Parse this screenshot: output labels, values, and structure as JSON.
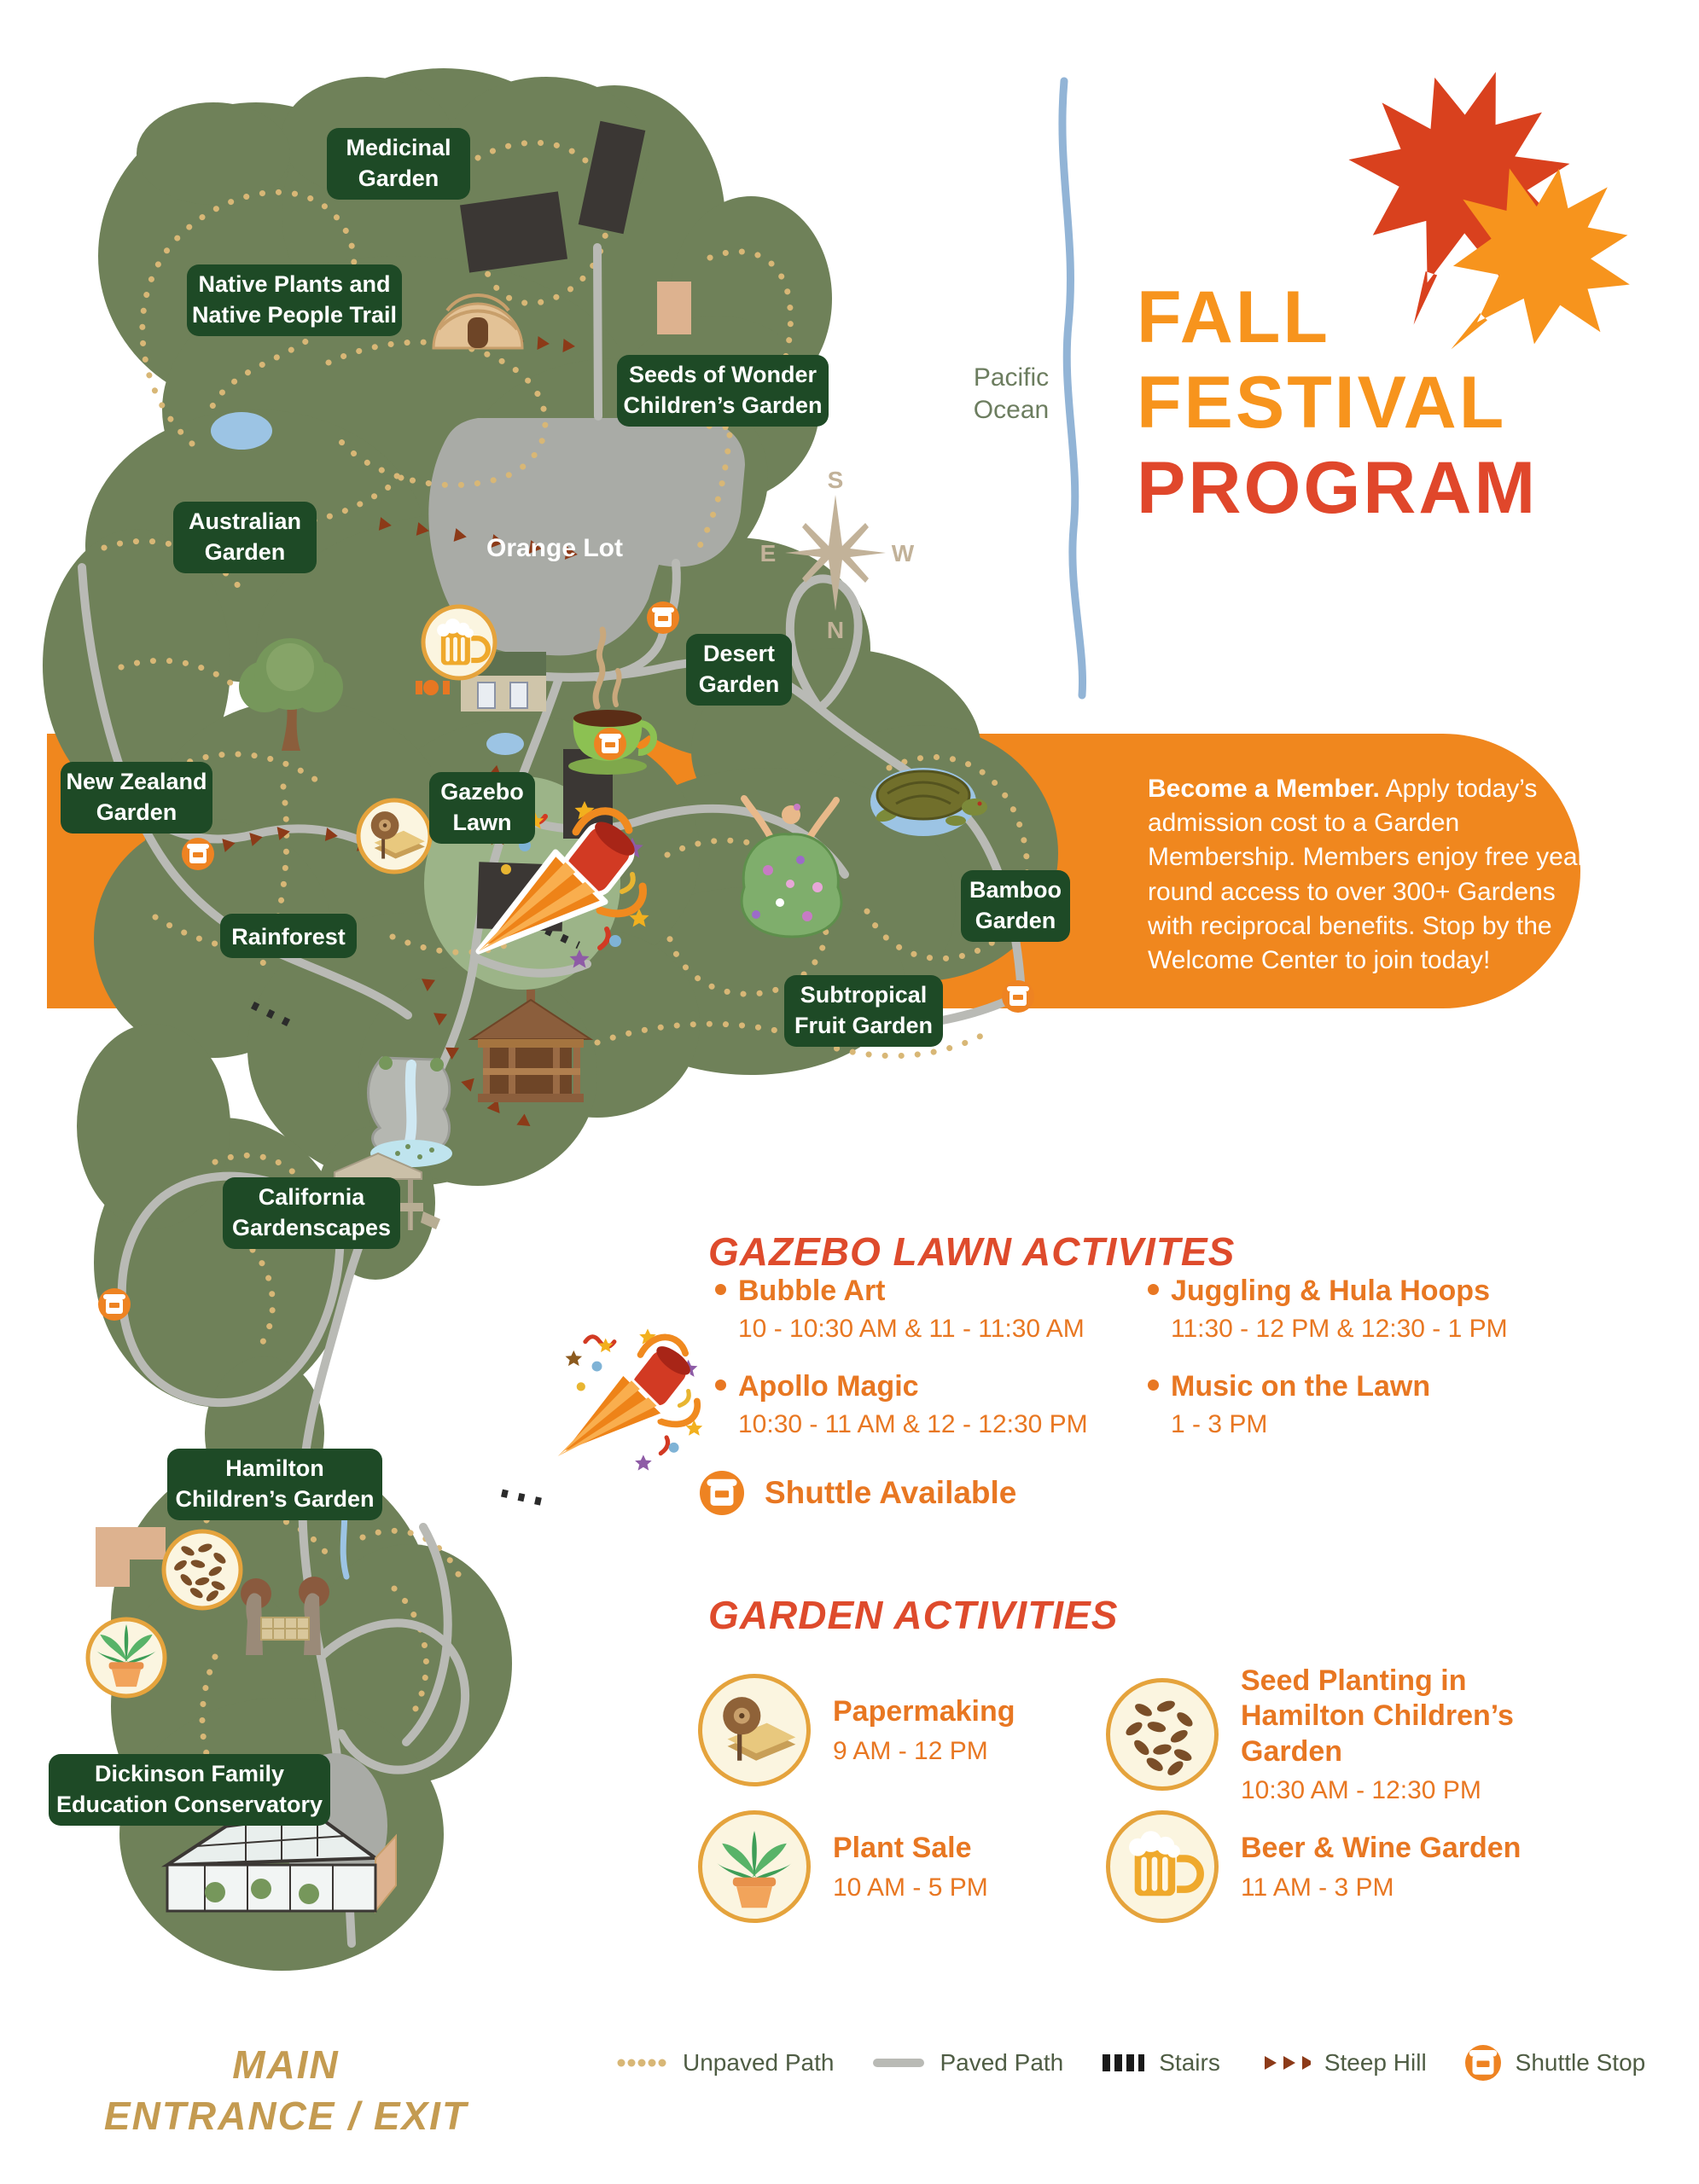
{
  "title": {
    "lines": [
      "FALL",
      "FESTIVAL",
      "PROGRAM"
    ]
  },
  "ocean": {
    "lines": [
      "Pacific",
      "Ocean"
    ]
  },
  "compass": {
    "top": "S",
    "left": "E",
    "right": "W",
    "bottom": "N"
  },
  "member_banner": {
    "lead": "Become a Member.",
    "body": " Apply today’s admission cost to a Garden Membership. Members enjoy free year round access to over 300+ Gardens with reciprocal benefits. Stop by the Welcome Center to join today!"
  },
  "map": {
    "orange_lot": "Orange Lot",
    "labels": [
      {
        "lines": [
          "Medicinal",
          "Garden"
        ]
      },
      {
        "lines": [
          "Native Plants and",
          "Native People Trail"
        ]
      },
      {
        "lines": [
          "Seeds of Wonder",
          "Children’s Garden"
        ]
      },
      {
        "lines": [
          "Australian",
          "Garden"
        ]
      },
      {
        "lines": [
          "Desert",
          "Garden"
        ]
      },
      {
        "lines": [
          "New Zealand",
          "Garden"
        ]
      },
      {
        "lines": [
          "Gazebo",
          "Lawn"
        ]
      },
      {
        "lines": [
          "Rainforest"
        ]
      },
      {
        "lines": [
          "Bamboo",
          "Garden"
        ]
      },
      {
        "lines": [
          "Subtropical",
          "Fruit Garden"
        ]
      },
      {
        "lines": [
          "California",
          "Gardenscapes"
        ]
      },
      {
        "lines": [
          "Hamilton",
          "Children’s Garden"
        ]
      },
      {
        "lines": [
          "Dickinson Family",
          "Education Conservatory"
        ]
      }
    ]
  },
  "gazebo_activities": {
    "heading": "GAZEBO LAWN ACTIVITES",
    "items": [
      {
        "name": "Bubble Art",
        "time": "10 - 10:30 AM & 11 - 11:30 AM"
      },
      {
        "name": "Apollo Magic",
        "time": "10:30 - 11 AM & 12 - 12:30 PM"
      },
      {
        "name": "Juggling & Hula Hoops",
        "time": "11:30 - 12 PM & 12:30 - 1 PM"
      },
      {
        "name": "Music on the Lawn",
        "time": "1 - 3 PM"
      }
    ],
    "shuttle_note": "Shuttle Available"
  },
  "garden_activities": {
    "heading": "GARDEN ACTIVITIES",
    "items": [
      {
        "name": "Papermaking",
        "time": "9 AM - 12 PM",
        "icon": "paper-roll-icon"
      },
      {
        "name": "Seed Planting in Hamilton Children’s Garden",
        "time": "10:30 AM - 12:30 PM",
        "icon": "seeds-icon"
      },
      {
        "name": "Plant Sale",
        "time": "10 AM - 5 PM",
        "icon": "potted-plant-icon"
      },
      {
        "name": "Beer & Wine Garden",
        "time": "11 AM - 3 PM",
        "icon": "beer-mug-icon"
      }
    ]
  },
  "entrance": {
    "lines": [
      "MAIN",
      "ENTRANCE / EXIT"
    ]
  },
  "legend": {
    "items": [
      "Unpaved Path",
      "Paved Path",
      "Stairs",
      "Steep Hill",
      "Shuttle Stop"
    ]
  },
  "colors": {
    "accent_orange": "#F0871E",
    "title_orange": "#F7941D",
    "title_red": "#E0472B",
    "activity_orange": "#E87722",
    "label_green": "#1E4A26",
    "map_green": "#6F8159",
    "path_gray": "#B9BAB5",
    "trail_tan": "#D8B776",
    "ocean_blue": "#92B4D6",
    "steep_brown": "#8C3A18",
    "shuttle_orange": "#EE8322"
  }
}
